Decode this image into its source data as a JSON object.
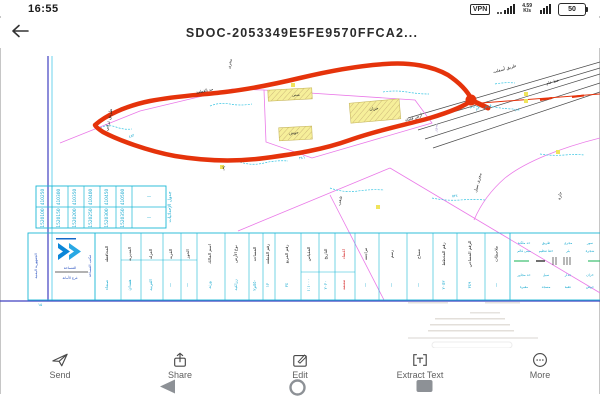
{
  "status_bar": {
    "time": "16:55",
    "vpn_label": "VPN",
    "net_speed_value": "4.59",
    "net_speed_unit": "K/s",
    "battery_percent": "50"
  },
  "header": {
    "title": "SDOC-2053349E5FE9570FFCA2..."
  },
  "drawing": {
    "labels": {
      "road1": "طريق أسفلت",
      "road2": "خط عام",
      "dirt_road": "طريق ترابي",
      "boundary": "حد القطعة",
      "stream_top": "مجرى",
      "bldg1": "مبنى",
      "bldg2": "خزان",
      "bldg3": "حوش",
      "open_land": "أرض فضاء",
      "wall": "سور",
      "stream_right": "مجرى سيل",
      "ravine": "شعب",
      "well": "بئر",
      "district": "حارة",
      "width_note": "عرض ٣٠م",
      "m1": "٤٥٢",
      "m2": "٣٨٦",
      "m3": "٥٢٤",
      "m4": "٦١٨",
      "tiny_note": "١٥"
    },
    "coord_table": {
      "title": "جدول الإحداثيات",
      "row1": [
        "410250",
        "410300",
        "410350",
        "410400",
        "410450",
        "410500"
      ],
      "row2": [
        "1520100",
        "1520150",
        "1520200",
        "1520250",
        "1520300",
        "1520350"
      ],
      "dash": "—"
    },
    "main_table": {
      "columns": [
        {
          "h": "المحافظة",
          "v": "صنعاء",
          "red": false
        },
        {
          "h": "المديرية",
          "v": "همدان",
          "red": false
        },
        {
          "h": "العزلة",
          "v": "الغربية",
          "red": false
        },
        {
          "h": "القرية",
          "v": "—",
          "red": false
        },
        {
          "h": "الحوز",
          "v": "—",
          "red": false
        },
        {
          "h": "اسم المالك",
          "v": "ورثة",
          "red": false
        },
        {
          "h": "نوع الأرض",
          "v": "زراعية",
          "red": false
        },
        {
          "h": "المساحة",
          "v": "٥٥٠م٢",
          "red": false
        },
        {
          "h": "رقم القطعة",
          "v": "١٢",
          "red": false
        },
        {
          "h": "رقم المربع",
          "v": "٣٤",
          "red": false
        },
        {
          "h": "المقياس",
          "v": "١:١٠٠٠",
          "red": false
        },
        {
          "h": "التاريخ",
          "v": "٢٠٢٠",
          "red": false
        },
        {
          "h": "اعتماد",
          "v": "معتمد",
          "red": true
        },
        {
          "h": "مراجعة",
          "v": "—",
          "red": false
        },
        {
          "h": "رسم",
          "v": "—",
          "red": false
        },
        {
          "h": "مساح",
          "v": "—",
          "red": false
        },
        {
          "h": "رقم المخطط",
          "v": "٢٠٥٣",
          "red": false
        },
        {
          "h": "الرقم المساحي",
          "v": "٣٤٩",
          "red": false
        },
        {
          "h": "ملاحظات",
          "v": "—",
          "red": false
        }
      ]
    },
    "legend": {
      "items": [
        "حد ملكية",
        "طريق",
        "مجرى",
        "سور",
        "مبنى قائم",
        "خط تنظيم",
        "بئر",
        "شجرة",
        "حد مجاور",
        "سيل",
        "جدار",
        "خزان",
        "مقبرة",
        "مسجد",
        "عقبة",
        "حوش"
      ]
    },
    "logo": {
      "line1": "الجمهورية اليمنية",
      "line2": "المساحة",
      "line3": "فرع الأمانة",
      "side": "مكتب المساحة"
    }
  },
  "toolbar": {
    "items": [
      {
        "label": "Send"
      },
      {
        "label": "Share"
      },
      {
        "label": "Edit"
      },
      {
        "label": "Extract Text"
      },
      {
        "label": "More"
      }
    ]
  },
  "colors": {
    "boundary_red": "#e5330b",
    "parcel_magenta": "#ea7ae8",
    "cad_cyan": "#35c4e2",
    "table_cyan": "#1ab8d6",
    "building_yellow": "#f6ef9a",
    "logo_blue": "#0a86d8"
  }
}
